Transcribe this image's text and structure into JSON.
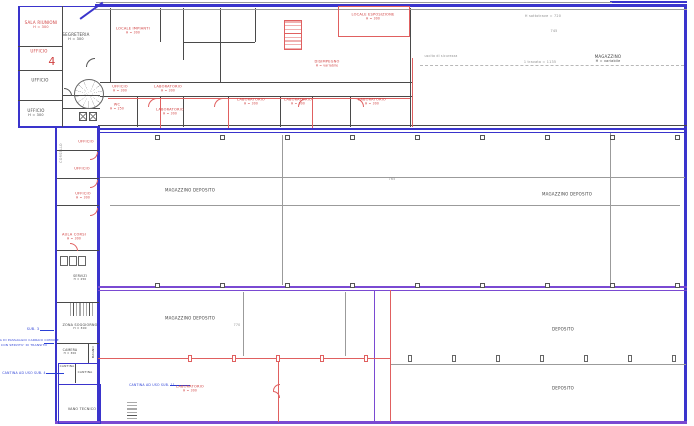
{
  "meta": {
    "drawing_type": "architectural floor plan (CAD)",
    "colors": {
      "outline_blue": "#3a34cc",
      "outline_purple": "#7a4ad2",
      "walls_black": "#4a4a4a",
      "marks_red": "#d04040",
      "notes_blue": "#2a3fd6",
      "dims_gray": "#8d8d8d",
      "background": "#ffffff"
    }
  },
  "labels": [
    {
      "name": "sala-riunioni",
      "text": "SALA RIUNIONI",
      "sub": "H = 300",
      "x": 41,
      "y": 25,
      "c": "red",
      "s": 4
    },
    {
      "name": "segreteria",
      "text": "SEGRETERIA",
      "sub": "H = 300",
      "x": 76,
      "y": 37,
      "c": "black",
      "s": 4
    },
    {
      "name": "ufficio-a",
      "text": "UFFICIO",
      "x": 39,
      "y": 51,
      "c": "red",
      "s": 4
    },
    {
      "name": "marker-4",
      "text": "4",
      "x": 52,
      "y": 62,
      "c": "red",
      "s": 11
    },
    {
      "name": "ufficio-b",
      "text": "UFFICIO",
      "x": 40,
      "y": 80,
      "c": "black",
      "s": 4
    },
    {
      "name": "ufficio-c",
      "text": "UFFICIO",
      "sub": "H = 300",
      "x": 36,
      "y": 113,
      "c": "black",
      "s": 4
    },
    {
      "name": "locale-impianti",
      "text": "LOCALE IMPIANTI",
      "sub": "H = 300",
      "x": 133,
      "y": 31,
      "c": "red",
      "s": 3.6
    },
    {
      "name": "locale-esposizione",
      "text": "LOCALE ESPOSIZIONE",
      "sub": "H = 300",
      "x": 373,
      "y": 17,
      "c": "red",
      "s": 3.6
    },
    {
      "name": "disimpegno",
      "text": "DISIMPEGNO",
      "sub": "H = variabile",
      "x": 327,
      "y": 64,
      "c": "red",
      "s": 3.6
    },
    {
      "name": "ufficio-d",
      "text": "UFFICIO",
      "sub": "H = 300",
      "x": 120,
      "y": 89,
      "c": "red",
      "s": 3.6
    },
    {
      "name": "laboratorio-a",
      "text": "LABORATORIO",
      "sub": "H = 300",
      "x": 168,
      "y": 89,
      "c": "red",
      "s": 3.6
    },
    {
      "name": "wc",
      "text": "WC",
      "sub": "H = 250",
      "x": 117,
      "y": 107,
      "c": "red",
      "s": 3.6
    },
    {
      "name": "laboratorio-b",
      "text": "LABORATORIO",
      "sub": "H = 300",
      "x": 170,
      "y": 112,
      "c": "red",
      "s": 3.6
    },
    {
      "name": "laboratorio-c",
      "text": "LABORATORIO",
      "sub": "H = 300",
      "x": 251,
      "y": 102,
      "c": "red",
      "s": 3.6
    },
    {
      "name": "laboratorio-d",
      "text": "LABORATORIO",
      "sub": "H = 300",
      "x": 298,
      "y": 102,
      "c": "red",
      "s": 3.6
    },
    {
      "name": "laboratorio-e",
      "text": "LABORATORIO",
      "sub": "H = 300",
      "x": 372,
      "y": 102,
      "c": "red",
      "s": 3.6
    },
    {
      "name": "magazzino",
      "text": "MAGAZZINO",
      "sub": "H = variabile",
      "x": 608,
      "y": 59,
      "c": "black",
      "s": 4
    },
    {
      "name": "dim-sottotrave",
      "text": "H sottotrave = 720",
      "x": 543,
      "y": 16,
      "c": "gray",
      "s": 3.4
    },
    {
      "name": "dim-745",
      "text": "745",
      "x": 554,
      "y": 31,
      "c": "gray",
      "s": 3.4
    },
    {
      "name": "dim-travata",
      "text": "1 travata = 1135",
      "x": 540,
      "y": 62,
      "c": "gray",
      "s": 3.4
    },
    {
      "name": "uscita-sicurezza",
      "text": "uscita di sicurezza",
      "x": 441,
      "y": 56,
      "c": "gray",
      "s": 3.2
    },
    {
      "name": "magazzino-deposito-1",
      "text": "MAGAZZINO DEPOSITO",
      "x": 190,
      "y": 190,
      "c": "black",
      "s": 4
    },
    {
      "name": "magazzino-deposito-2",
      "text": "MAGAZZINO DEPOSITO",
      "x": 567,
      "y": 194,
      "c": "black",
      "s": 4
    },
    {
      "name": "dim-765",
      "text": "765",
      "x": 392,
      "y": 179,
      "c": "gray",
      "s": 3.4
    },
    {
      "name": "magazzino-deposito-3",
      "text": "MAGAZZINO DEPOSITO",
      "x": 190,
      "y": 318,
      "c": "black",
      "s": 4
    },
    {
      "name": "dim-770",
      "text": "770",
      "x": 237,
      "y": 325,
      "c": "gray",
      "s": 3.2
    },
    {
      "name": "deposito-1",
      "text": "DEPOSITO",
      "x": 563,
      "y": 329,
      "c": "black",
      "s": 4
    },
    {
      "name": "deposito-2",
      "text": "DEPOSITO",
      "x": 563,
      "y": 388,
      "c": "black",
      "s": 4
    },
    {
      "name": "laboratorio-f",
      "text": "LABORATORIO",
      "sub": "H = 300",
      "x": 190,
      "y": 389,
      "c": "red",
      "s": 3.6
    },
    {
      "name": "nota-sub11",
      "text": "CANTINA AD USO SUB. 11",
      "x": 152,
      "y": 385,
      "c": "blue",
      "s": 3.2
    },
    {
      "name": "ufficio-e",
      "text": "UFFICIO",
      "x": 86,
      "y": 142,
      "c": "red",
      "s": 3.6
    },
    {
      "name": "ufficio-f",
      "text": "UFFICIO",
      "x": 82,
      "y": 169,
      "c": "red",
      "s": 3.6
    },
    {
      "name": "ufficio-g",
      "text": "UFFICIO",
      "sub": "H = 300",
      "x": 83,
      "y": 196,
      "c": "red",
      "s": 3.6
    },
    {
      "name": "aula-corsi",
      "text": "AULA CORSI",
      "sub": "H = 300",
      "x": 74,
      "y": 237,
      "c": "red",
      "s": 3.6
    },
    {
      "name": "corsello",
      "text": "CORSELLO",
      "x": 61,
      "y": 153,
      "c": "gray",
      "s": 3.4,
      "r": -90
    },
    {
      "name": "servizi",
      "text": "SERVIZI",
      "sub": "H = 250",
      "x": 80,
      "y": 278,
      "c": "black",
      "s": 3.2
    },
    {
      "name": "zona-soggiorno",
      "text": "ZONA SOGGIORNO",
      "sub": "H = 300",
      "x": 80,
      "y": 327,
      "c": "black",
      "s": 3.4
    },
    {
      "name": "camera",
      "text": "CAMERA",
      "sub": "H = 300",
      "x": 70,
      "y": 352,
      "c": "black",
      "s": 3.2
    },
    {
      "name": "bagno",
      "text": "BAGNO",
      "x": 94,
      "y": 352,
      "c": "black",
      "s": 3,
      "r": -90
    },
    {
      "name": "cantina-1",
      "text": "CANTINA",
      "x": 67,
      "y": 367,
      "c": "black",
      "s": 3
    },
    {
      "name": "cantina-2",
      "text": "CANTINA",
      "x": 85,
      "y": 373,
      "c": "black",
      "s": 3
    },
    {
      "name": "vano-tecnico",
      "text": "VANO TECNICO",
      "x": 82,
      "y": 409,
      "c": "black",
      "s": 3.4
    },
    {
      "name": "sub-3",
      "text": "SUB. 3",
      "x": 33,
      "y": 329,
      "c": "blue",
      "s": 3.4
    },
    {
      "name": "nota-area-1",
      "text": "AREA DI PASSAGGIO CARRAIO COMUNE",
      "x": 26,
      "y": 341,
      "c": "blue",
      "s": 3
    },
    {
      "name": "nota-area-2",
      "text": "CON SERVITU' DI TRANSITO",
      "x": 24,
      "y": 346,
      "c": "blue",
      "s": 3
    },
    {
      "name": "nota-sub4",
      "text": "CANTINA AD USO SUB. 4",
      "x": 24,
      "y": 373,
      "c": "blue",
      "s": 3.2
    }
  ]
}
